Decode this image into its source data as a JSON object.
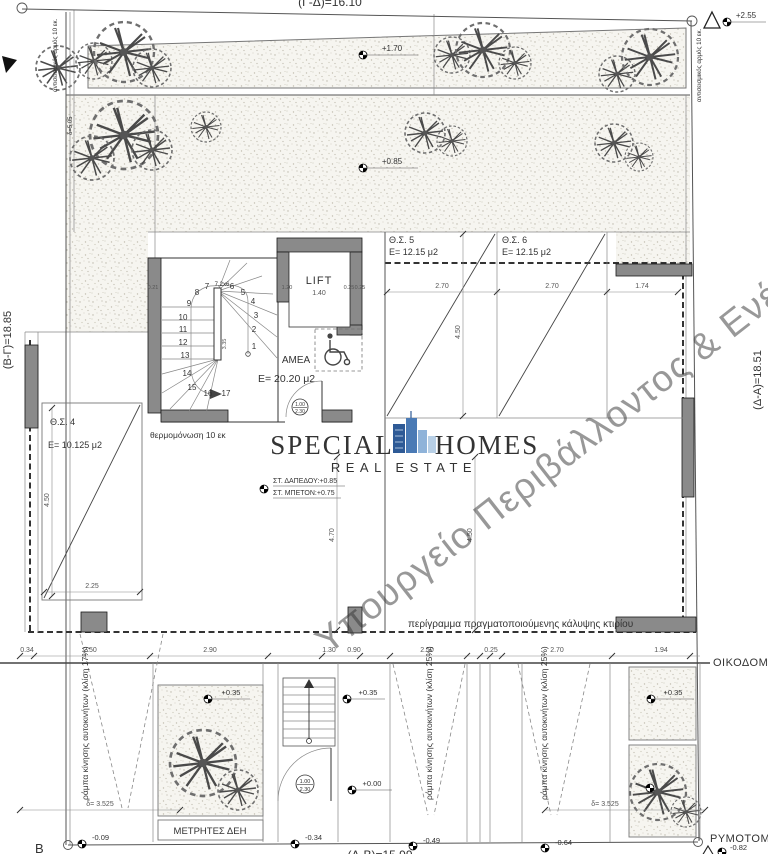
{
  "boundary": {
    "top": "(Γ-Δ)=16.10",
    "left": "(Β-Γ)=18.85",
    "right": "(Δ-Α)=18.51",
    "bottom": "(Α-Β)=15.99",
    "corner_b": "Β",
    "oikodomiki": "ΟΙΚΟΔΟΜΙΚΗ",
    "rymotomiki": "ΡΥΜΟΤΟΜΙΚΗ"
  },
  "notes": {
    "seismic_joint": "αντισεισμικός αρμός 10 εκ.",
    "coverage_outline": "περίγραμμα πραγματοποιούμενης κάλυψης κτιρίου",
    "insulation": "θερμομόνωση 10 εκ",
    "delta_top": "δ=5.05",
    "ramp_left": "ράμπα κίνησης αυτοκινήτων (κλίση 17%)",
    "ramp_25": "ράμπα κίνησης αυτοκινήτων (κλίση 25%)",
    "ramp_span": "δ= 3.525"
  },
  "rooms": {
    "lift_label": "LIFT",
    "lift_width": "1.40",
    "amea_label": "ΑΜΕΑ",
    "lobby_area": "E= 20.20 μ2",
    "stair_note": "7,2x6",
    "meters_label": "ΜΕΤΡΗΤΕΣ ΔΕΗ",
    "floor_level": "ΣΤ. ΔΑΠΕΔΟΥ:+0.85",
    "concrete_level": "ΣΤ. ΜΠΕΤΟΝ:+0.75",
    "door_width": "1.00",
    "door_height": "2.30"
  },
  "parking": {
    "p4_name": "Θ.Σ. 4",
    "p4_area": "E= 10.125 μ2",
    "p5_name": "Θ.Σ. 5",
    "p5_area": "E= 12.15 μ2",
    "p6_name": "Θ.Σ. 6",
    "p6_area": "E= 12.15 μ2"
  },
  "levels": {
    "l255": "+2.55",
    "l170": "+1.70",
    "l085": "+0.85",
    "l035": "+0.35",
    "l000": "+0.00",
    "m009": "-0.09",
    "m034": "-0.34",
    "m049": "-0.49",
    "m064": "-0.64",
    "m082": "-0.82"
  },
  "dims": {
    "d270": "2.70",
    "d174": "1.74",
    "d450": "4.50",
    "d470": "4.70",
    "d335": "3.35",
    "d225": "2.25",
    "d021": "0.21",
    "d025": "0.25",
    "d120": "1.20",
    "d034": "0.34",
    "d250": "2.50",
    "d290": "2.90",
    "d130": "1.30",
    "d090": "0.90",
    "d194": "1.94"
  },
  "stairs": {
    "numbers": [
      "1",
      "2",
      "3",
      "4",
      "5",
      "6",
      "7",
      "8",
      "9",
      "10",
      "11",
      "12",
      "13",
      "14",
      "15",
      "16",
      "17"
    ]
  },
  "watermark": {
    "brand_left": "SPECIAL",
    "brand_right": "HOMES",
    "subtitle": "REAL ESTATE",
    "ministry": "Υπουργείο Περιβάλλοντος & Ενέ",
    "brand_color": "#26427c",
    "subtitle_color": "#7fb2d6",
    "ministry_color": "#9b86c8"
  }
}
